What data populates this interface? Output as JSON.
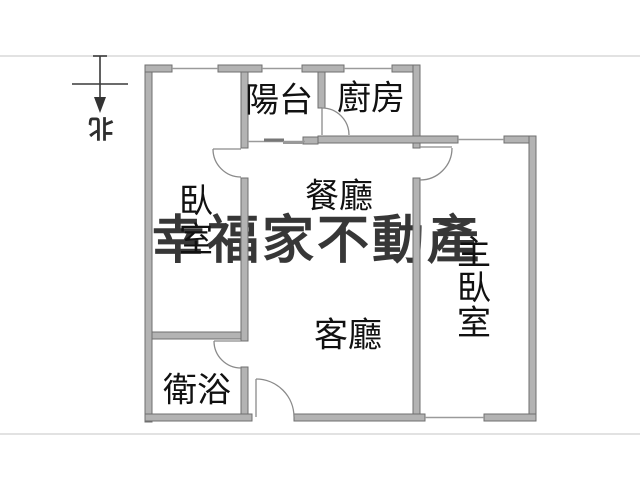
{
  "north": {
    "label": "北"
  },
  "watermark": {
    "text": "幸福家不動產",
    "color": "#9e9e9e"
  },
  "rooms": {
    "balcony": {
      "label": "陽台"
    },
    "kitchen": {
      "label": "廚房"
    },
    "dining": {
      "label": "餐廳"
    },
    "living": {
      "label": "客廳"
    },
    "bathroom": {
      "label": "衛浴"
    },
    "bedroom": {
      "label": "臥室",
      "chars": [
        "臥",
        "室"
      ]
    },
    "master_bedroom": {
      "label": "主臥室",
      "chars": [
        "主",
        "臥",
        "室"
      ]
    }
  },
  "colors": {
    "wall_fill": "#b3b3b3",
    "wall_stroke": "#6f6f6f",
    "door_arc": "#8a8a8a",
    "window_line": "#9a9a9a",
    "slider_dark": "#777777",
    "frame_line": "#d8d8d8",
    "label_color": "#111111",
    "north_color": "#2f2f2f",
    "background": "#ffffff"
  }
}
